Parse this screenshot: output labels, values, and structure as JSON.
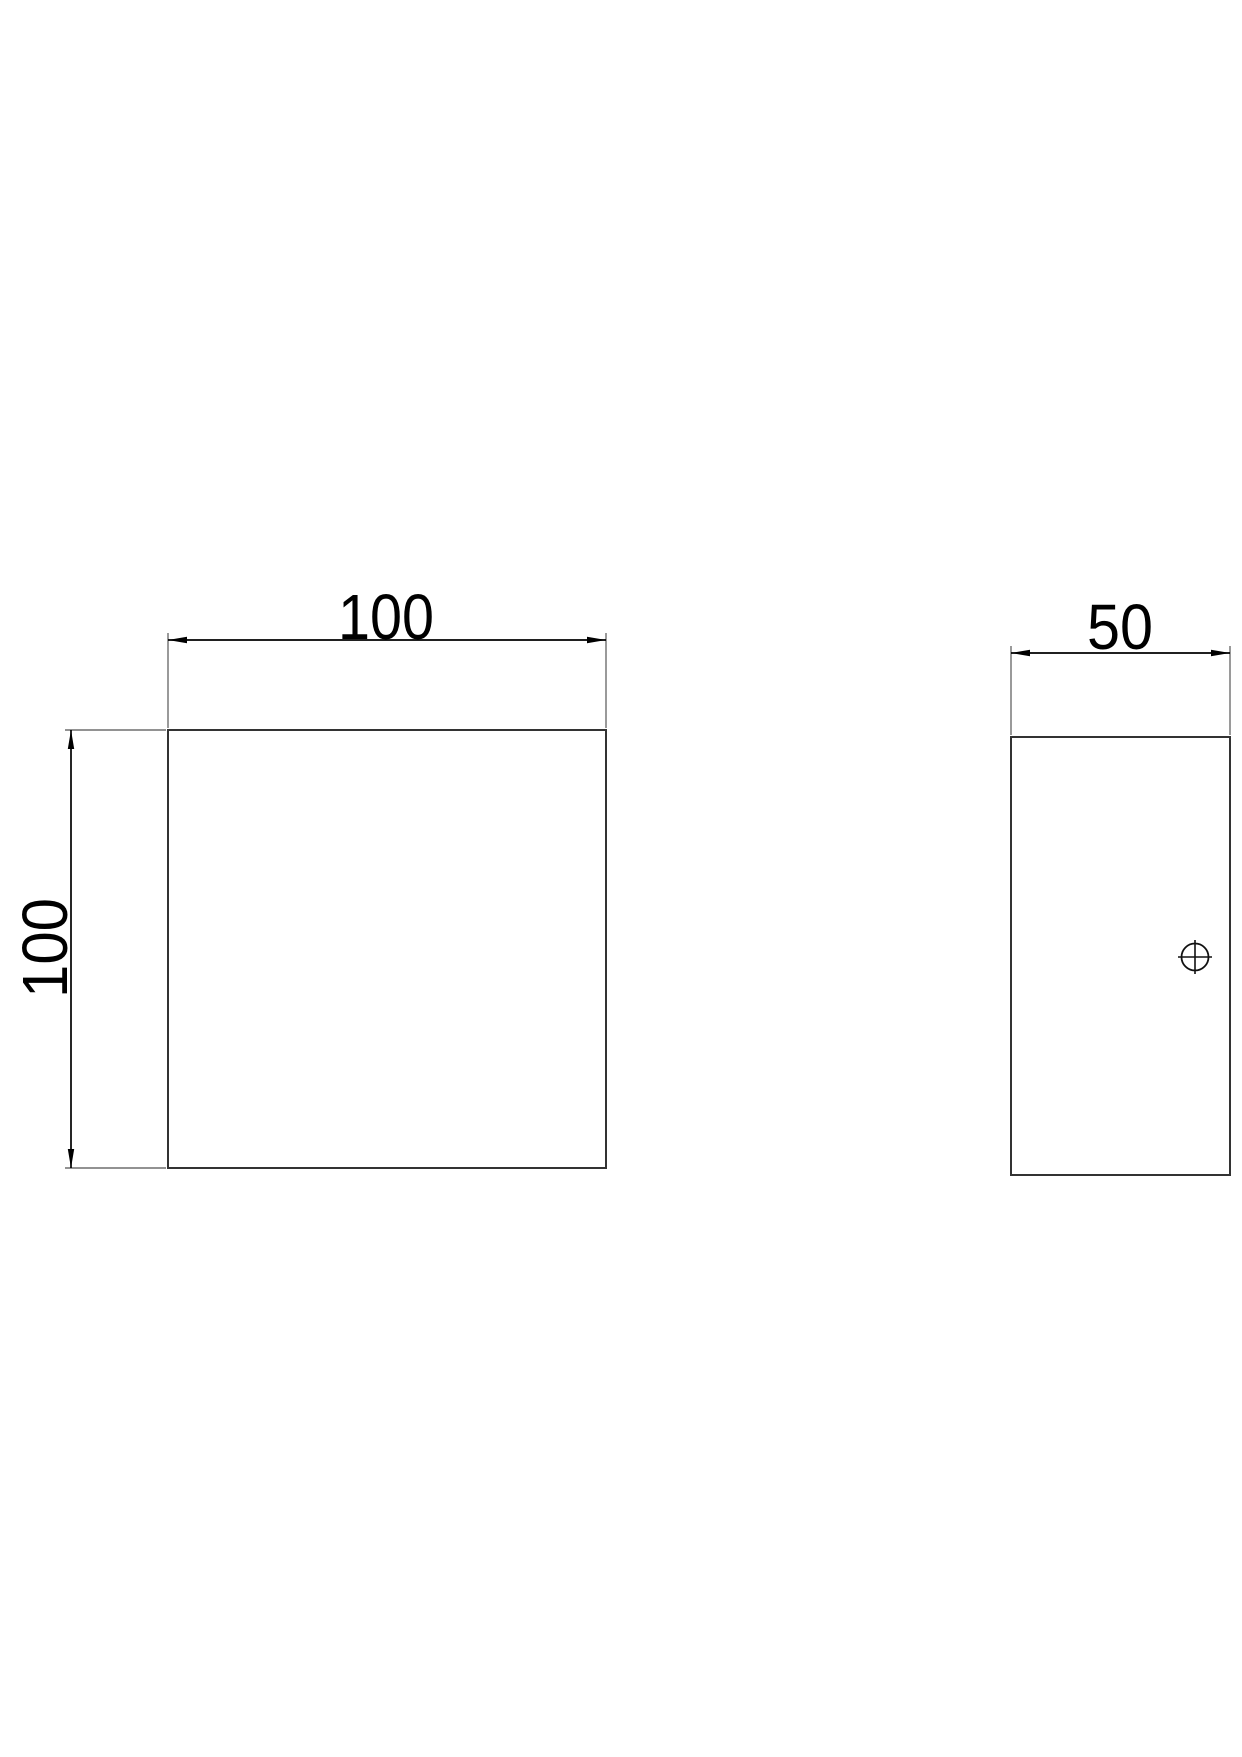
{
  "drawing": {
    "front_view": {
      "width_dimension": "100",
      "height_dimension": "100"
    },
    "side_view": {
      "width_dimension": "50"
    },
    "colors": {
      "background": "#ffffff",
      "object_line": "#333333",
      "extension_line": "#6e6e6e",
      "dimension_line": "#000000",
      "text": "#000000",
      "center_mark": "#111111"
    }
  }
}
